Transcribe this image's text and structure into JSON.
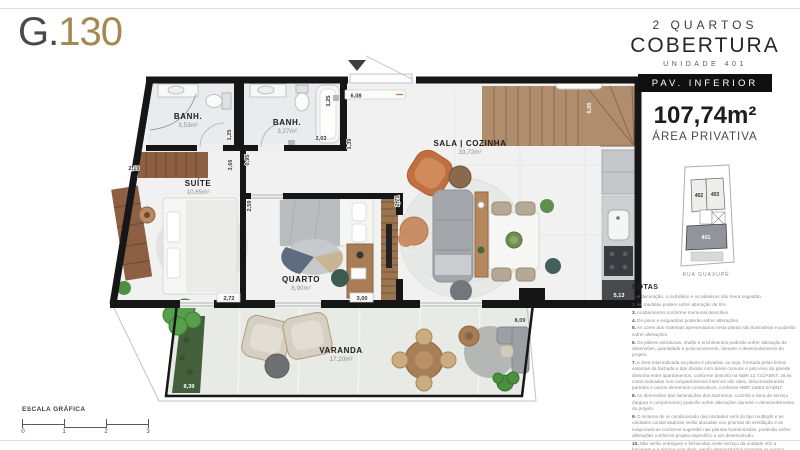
{
  "brand": {
    "logo_g": "G.",
    "logo_number": "130"
  },
  "panel": {
    "title_line1": "2 QUARTOS",
    "title_line2": "COBERTURA",
    "subtitle": "UNIDADE 401",
    "badge": "PAV. INFERIOR",
    "area_value": "107,74m²",
    "area_label": "ÁREA PRIVATIVA",
    "keyplan": {
      "unit_402": "402",
      "unit_403": "403",
      "unit_401": "401",
      "street": "RUA GUAXUPÉ"
    },
    "notes_title": "NOTAS",
    "notes": [
      {
        "n": "1.",
        "t": "A decoração, o mobiliário e os adesivos são mera sugestão."
      },
      {
        "n": "2.",
        "t": "As medidas podem sofrer alteração de 5%."
      },
      {
        "n": "3.",
        "t": "Acabamentos conforme memorial descritivo."
      },
      {
        "n": "4.",
        "t": "Os pisos e esquadrias poderão sofrer alterações."
      },
      {
        "n": "5.",
        "t": "As cores dos materiais apresentados nesta planta são ilustrativas e poderão sofrer alterações."
      },
      {
        "n": "6.",
        "t": "Os pilares estruturais, shafts e enchimentos poderão sofrer alteração de dimensões, quantidade e posicionamento, durante o desenvolvimento do projeto."
      },
      {
        "n": "7.",
        "t": "A área total indicada na planta é privativa, ou seja, formada pelas linhas externas da fachada e das divisas com áreas comuns e pelo eixo da parede divisória entre apartamentos, conforme descrito na NBR 12.721/ABNT. Já as cotas indicadas nos compartimentos internos são úteis, desconsiderando paredes e outros elementos construtivos, conforme NBR 14653-2/ABNT."
      },
      {
        "n": "8.",
        "t": "As dimensões das iluminações dos banheiros, cozinha e área de serviço (largura e comprimento) poderão sofrer alterações durante o desenvolvimento do projeto."
      },
      {
        "n": "9.",
        "t": "O sistema de ar condicionado das unidades será do tipo multisplit e as unidades condensadoras serão alocadas nos prismas de ventilação e as evaporadoras conforme sugestão nas plantas humanizadas, podendo sofrer alterações conforme projeto específico a ser desenvolvido."
      },
      {
        "n": "10.",
        "t": "Não serão entregues e fornecidas neste terraço da unidade 401 a banqueta e a piscina com deck, sendo demonstrados somente os pontos previstos para tal. A imagem é meramente ilustrativa e no terraço será entregue somente o piso, respeitando o projeto aprovado na SMU."
      }
    ]
  },
  "plan": {
    "rooms": {
      "banh1": {
        "name": "BANH.",
        "area": "3,53m²"
      },
      "banh2": {
        "name": "BANH.",
        "area": "3,27m²"
      },
      "suite": {
        "name": "SUÍTE",
        "area": "10,65m²"
      },
      "quarto": {
        "name": "QUARTO",
        "area": "8,90m²"
      },
      "sala": {
        "name": "SALA | COZINHA",
        "area": "33,72m²"
      },
      "varanda": {
        "name": "VARANDA",
        "area": "17,20m²"
      }
    },
    "dims": {
      "d219": "2,19",
      "d125a": "1,25",
      "d366": "3,66",
      "d095": "0,95",
      "d125b": "1,25",
      "d203": "2,03",
      "d139": "1,39",
      "d608": "6,08",
      "d505": "5,05",
      "d259": "2,59",
      "d271": "2,71",
      "d272": "2,72",
      "d300": "3,00",
      "d513": "5,13",
      "d809": "8,09",
      "d839": "8,39"
    }
  },
  "scalebar": {
    "label": "ESCALA GRÁFICA",
    "ticks": [
      "0",
      "1",
      "2",
      "3"
    ]
  },
  "colors": {
    "gold": "#a3894f",
    "wall": "#161616",
    "badge": "#101010"
  }
}
